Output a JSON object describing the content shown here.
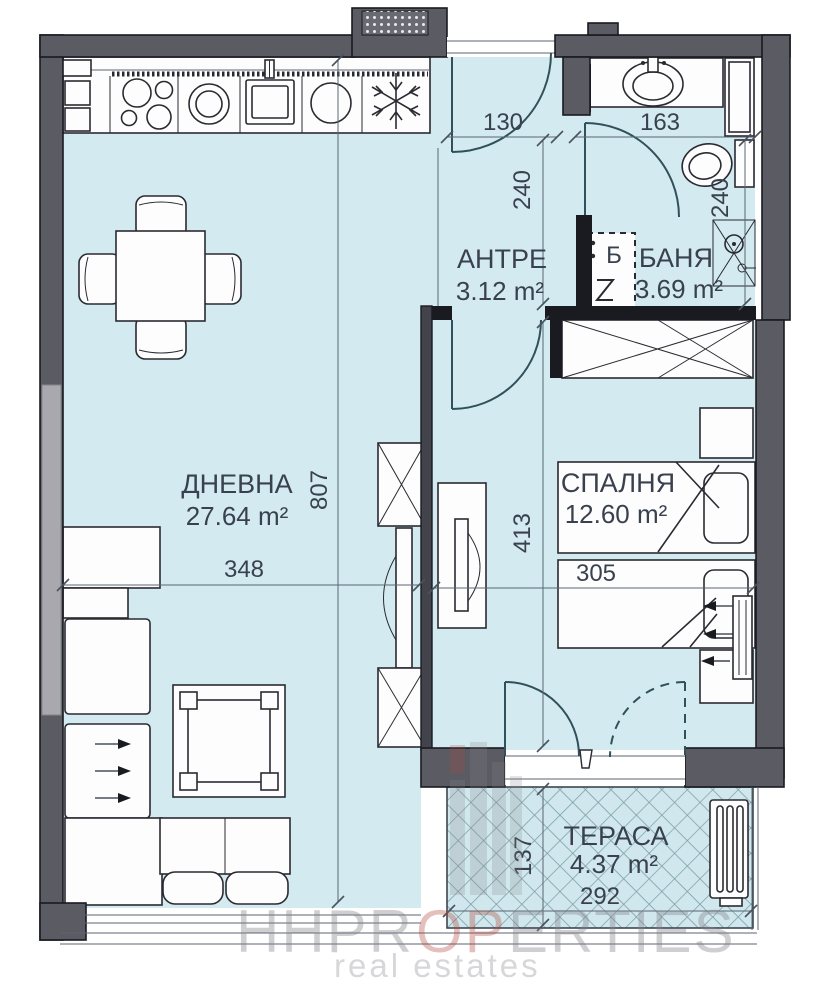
{
  "title": "apartment-floor-plan",
  "rooms": {
    "living": {
      "name": "ДНЕВНА",
      "area": "27.64 m²"
    },
    "hall": {
      "name": "АНТРЕ",
      "area": "3.12 m²"
    },
    "bath": {
      "name": "БАНЯ",
      "area": "3.69 m²"
    },
    "bedroom": {
      "name": "СПАЛНЯ",
      "area": "12.60 m²"
    },
    "terrace": {
      "name": "ТЕРАСА",
      "area": "4.37 m²"
    }
  },
  "dimensions": {
    "entry_width": "130",
    "bath_width": "163",
    "hall_depth": "240",
    "bath_depth": "240",
    "living_length": "807",
    "living_width": "348",
    "bedroom_length": "413",
    "bedroom_width": "305",
    "terrace_depth": "137",
    "terrace_width": "292"
  },
  "symbols": {
    "boiler": "Б"
  },
  "watermark": {
    "part1": "HHPR",
    "part2": "OP",
    "part3": "ERTIES",
    "tagline": "real estates"
  },
  "colors": {
    "floor": "#d3eaf0",
    "terrace_floor": "#cfe7ed",
    "wall": "#5b5b64",
    "wall_dark": "#1a1a21",
    "line": "#2a2a31",
    "door": "#30505a",
    "text": "#3a414e",
    "window": "#a8a8ae",
    "hatch": "#7b9ba3",
    "watermark_gray": "#84848a",
    "watermark_red": "#b2473c"
  }
}
